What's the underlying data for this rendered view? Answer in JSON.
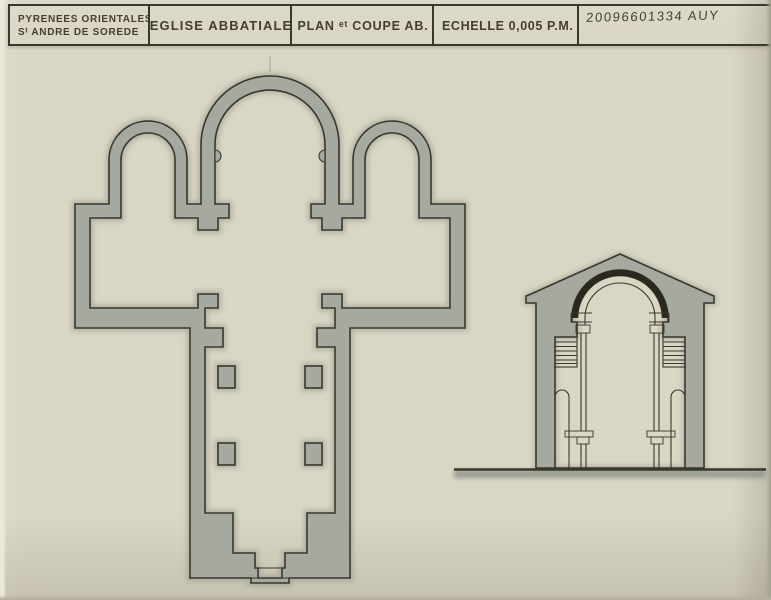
{
  "title_block": {
    "region_line1": "PYRENEES ORIENTALES",
    "region_line2": "Sᵗ ANDRE DE SOREDE",
    "building": "EGLISE ABBATIALE",
    "drawing_title": "PLAN ᵉᵗ COUPE AB.",
    "scale": "ECHELLE 0,005 P.M.",
    "reference_number": "20096601334 AUY"
  },
  "drawings": {
    "left_drawing": "floor plan of abbey church (three apses, transept, nave with four piers, west portal)",
    "right_drawing": "transverse section AB (gabled wall, barrel vault, aisle roofs, piers, ground line)"
  },
  "colors": {
    "paper": "#d8d3c0",
    "wall_fill": "#a5a9a0",
    "wall_halo": "#8f948a",
    "ink": "#3a372c",
    "arch_black": "#2b2820",
    "text_ink": "#453e2d"
  }
}
